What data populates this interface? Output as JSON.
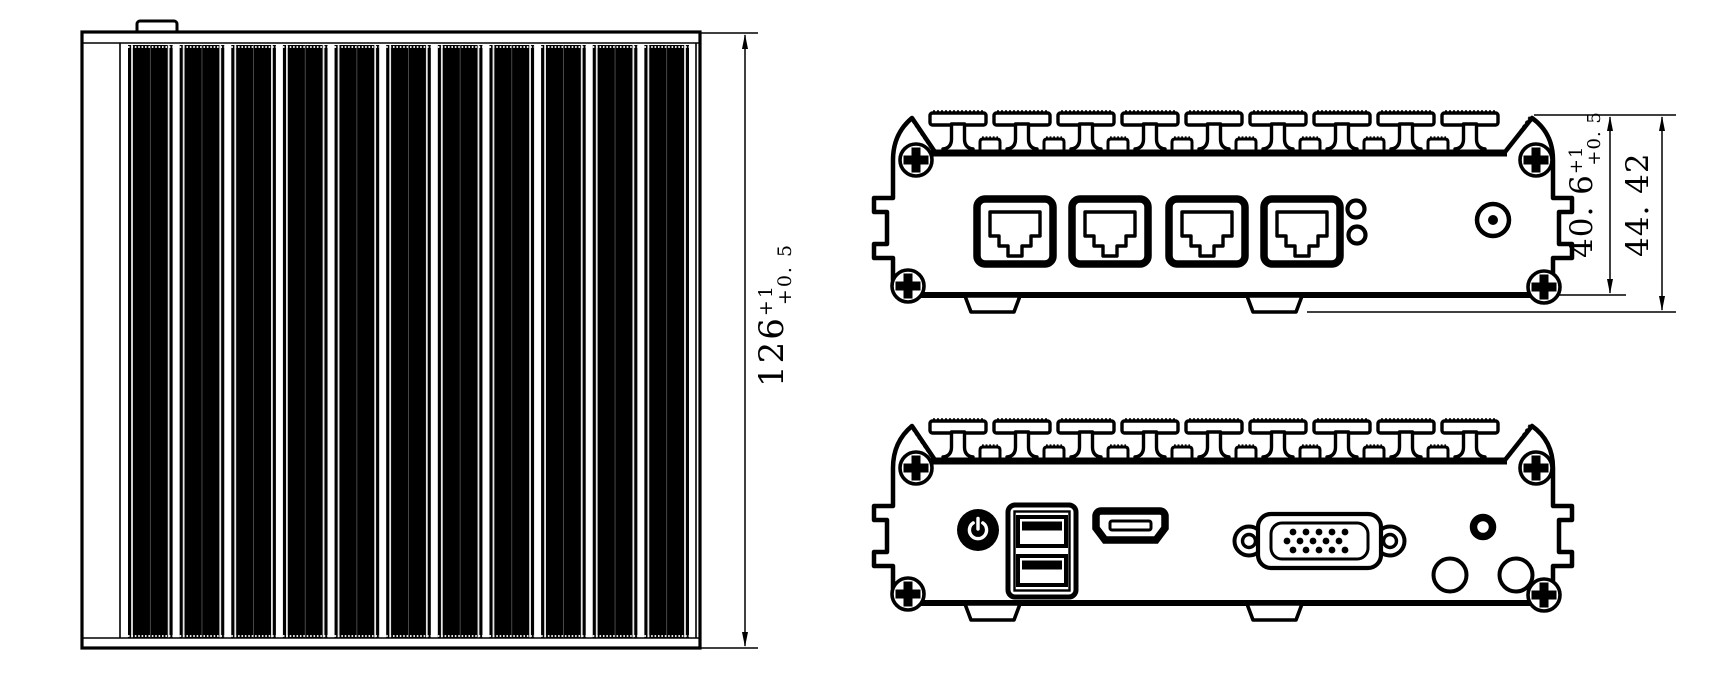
{
  "page": {
    "background": "#ffffff",
    "line_color": "#000000"
  },
  "dimensions": {
    "heatsink_width": {
      "value": "126",
      "tol_upper": "+1",
      "tol_lower": "+0. 5"
    },
    "body_height": {
      "value": "40. 6",
      "tol_upper": "+1",
      "tol_lower": "+0. 5"
    },
    "overall_height": {
      "value": "44. 42"
    }
  },
  "icons": {
    "screw-icon": "circle-with-cross",
    "rj45-port-icon": "ethernet-jack-outline",
    "led-indicator-icon": "small-circle",
    "dc-jack-icon": "circle-with-dot",
    "power-button-icon": "filled-circle-power-symbol",
    "usb-ports-icon": "stacked-dual-usb",
    "hdmi-port-icon": "trapezoid-slot",
    "vga-port-icon": "d-sub-15",
    "audio-jack-icon": "thick-ring",
    "antenna-hole-icon": "open-circle",
    "heatsink-fin-icon": "mushroom-fin",
    "mounting-tab-icon": "small-tab"
  }
}
